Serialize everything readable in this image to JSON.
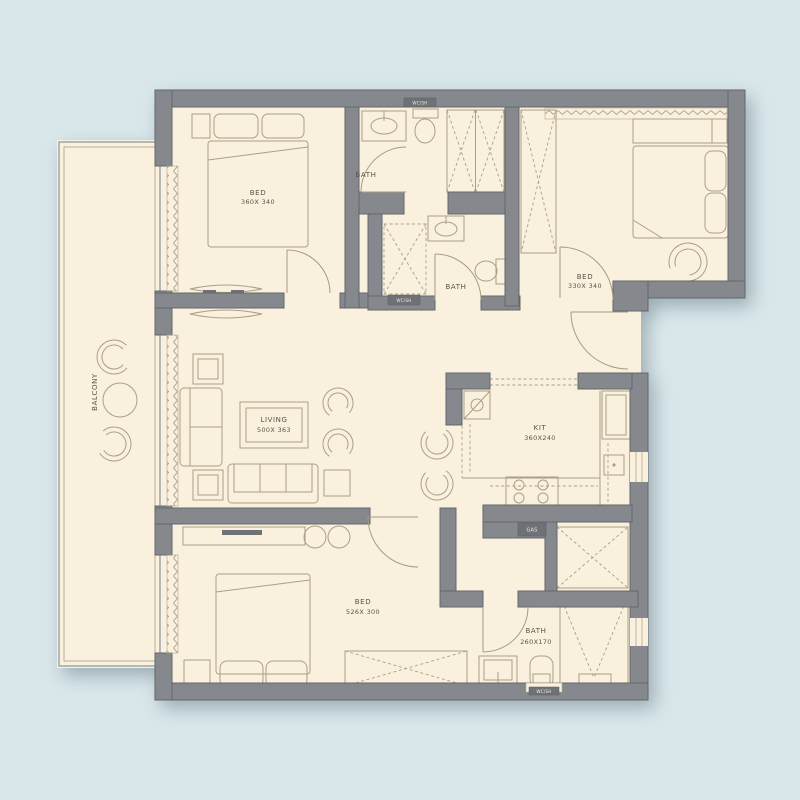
{
  "meta": {
    "background_color": "#d9e7eb",
    "floor_color": "#f9f1de",
    "wall_color": "#85898e",
    "furniture_line_color": "#ab9f85",
    "label_color": "#55534a"
  },
  "rooms": {
    "balcony": {
      "label": "BALCONY"
    },
    "bed_top_left": {
      "label": "BED",
      "dims": "360X 340"
    },
    "bath_top": {
      "label": "BATH"
    },
    "bed_top_right": {
      "label": "BED",
      "dims": "330X 340"
    },
    "bath_middle": {
      "label": "BATH"
    },
    "living": {
      "label": "LIVING",
      "dims": "500X 363"
    },
    "kitchen": {
      "label": "KIT",
      "dims": "360X240"
    },
    "bed_bottom": {
      "label": "BED",
      "dims": "526X 300"
    },
    "bath_bottom": {
      "label": "BATH",
      "dims": "260X170"
    }
  },
  "tags": {
    "gas": "GAS",
    "wc_top": "WC/SH",
    "wc_mid": "WC/SH",
    "wc_bottom": "WC/SH"
  }
}
